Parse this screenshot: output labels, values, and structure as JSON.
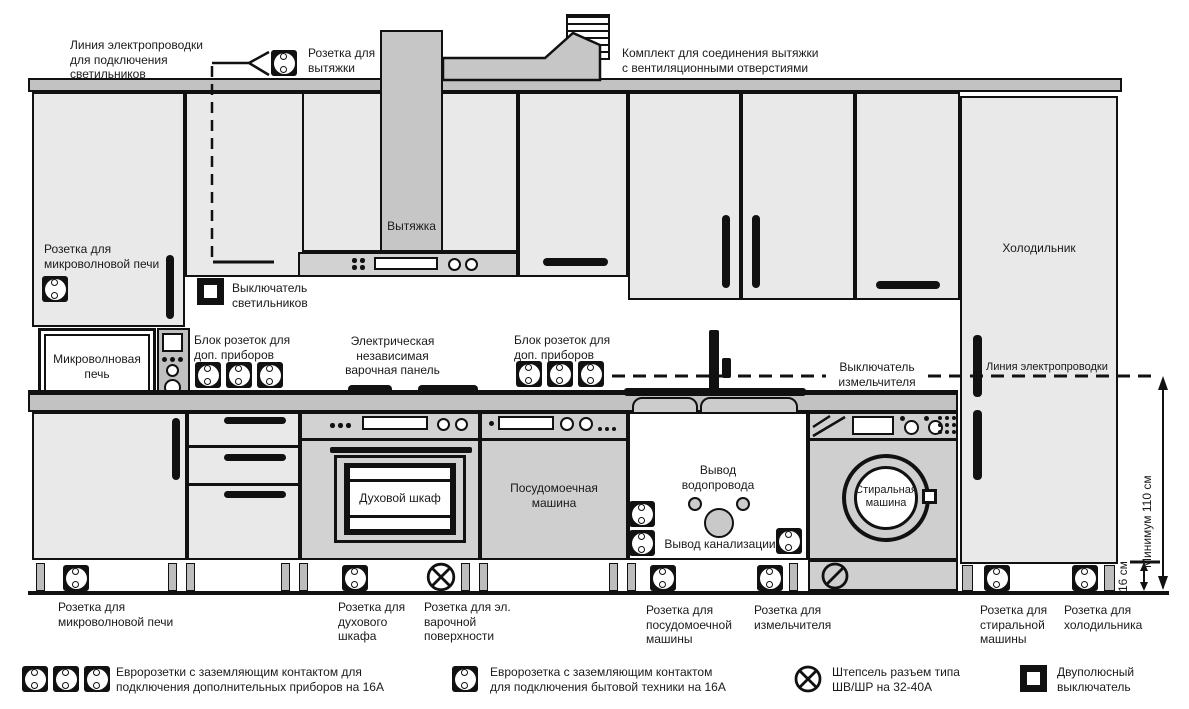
{
  "colors": {
    "outline": "#111111",
    "cabinet_fill": "#e9e9e9",
    "counter_fill": "#c2c2c2",
    "duct_fill": "#c6c6c6",
    "panel_fill": "#d2d2d2",
    "appliance_fill": "#cfcfcf",
    "text": "#1a1a1a"
  },
  "top": {
    "lighting_line_label": "Линия электропроводки для подключения светильников",
    "hood_socket_label": "Розетка для вытяжки",
    "vent_kit_label": "Комплект для соединения вытяжки с вентиляционными отверстиями"
  },
  "wall": {
    "microwave_socket_label": "Розетка для микроволновой печи",
    "lights_switch_label": "Выключатель светильников",
    "socket_block_left_label": "Блок розеток для доп. приборов",
    "hob_label": "Электрическая независимая варочная панель",
    "socket_block_right_label": "Блок розеток для доп. приборов",
    "grinder_switch_label": "Выключатель измельчителя",
    "wiring_line_label": "Линия электропроводки"
  },
  "appliances": {
    "hood": "Вытяжка",
    "microwave": "Микроволновая печь",
    "fridge": "Холодильник",
    "oven": "Духовой шкаф",
    "dishwasher": "Посудомоечная машина",
    "sink": "Мойка",
    "washer": "Стиральная машина"
  },
  "cabinet_area": {
    "water_supply_label": "Вывод водопровода",
    "sewage_label": "Вывод канализации"
  },
  "dimensions": {
    "min_height": "Минимум 110 см",
    "plinth_height": "16 см"
  },
  "socket_labels": [
    {
      "id": "microwave",
      "label": "Розетка для микроволновой печи"
    },
    {
      "id": "oven",
      "label": "Розетка для духового шкафа"
    },
    {
      "id": "hob",
      "label": "Розетка для эл. варочной поверхности"
    },
    {
      "id": "dishwasher",
      "label": "Розетка для посудомоечной машины"
    },
    {
      "id": "grinder",
      "label": "Розетка для измельчителя"
    },
    {
      "id": "washer",
      "label": "Розетка для стиральной машины"
    },
    {
      "id": "fridge",
      "label": "Розетка для холодильника"
    }
  ],
  "legend": [
    {
      "icon": "triple-euro-socket",
      "label": "Евророзетки с заземляющим контактом для подключения дополнительных приборов на 16А"
    },
    {
      "icon": "euro-socket",
      "label": "Евророзетка с заземляющим контактом для подключения бытовой техники на 16А"
    },
    {
      "icon": "plug-connector",
      "label": "Штепсель разъем типа ШВ/ШР на 32-40А"
    },
    {
      "icon": "bipolar-switch",
      "label": "Двуполюсный выключатель"
    }
  ]
}
